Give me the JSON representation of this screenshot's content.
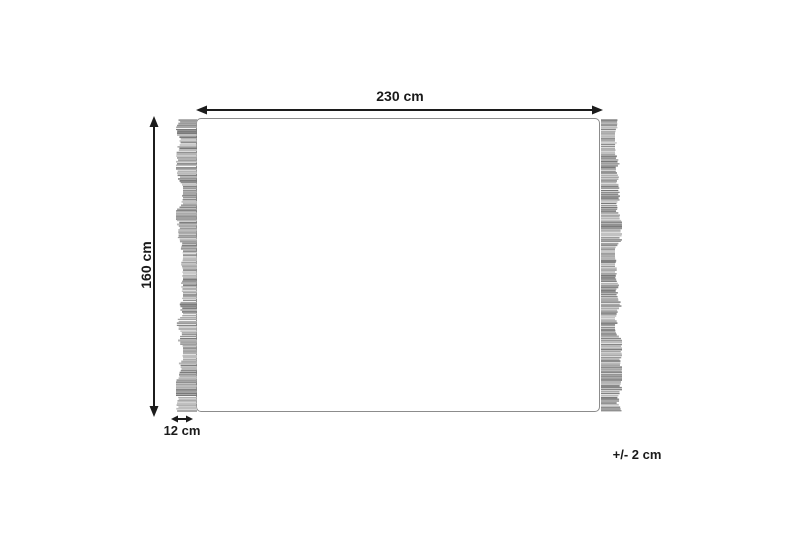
{
  "diagram": {
    "title": "rug-dimension-diagram",
    "labels": {
      "width": "230 cm",
      "height": "160 cm",
      "fringe": "12 cm",
      "tolerance": "+/- 2 cm"
    }
  },
  "colors": {
    "line": "#1c1c1c",
    "text": "#1a1a1a",
    "rug_border": "#8c8c8c",
    "fringe": "#9a9a9a",
    "background": "#ffffff"
  }
}
